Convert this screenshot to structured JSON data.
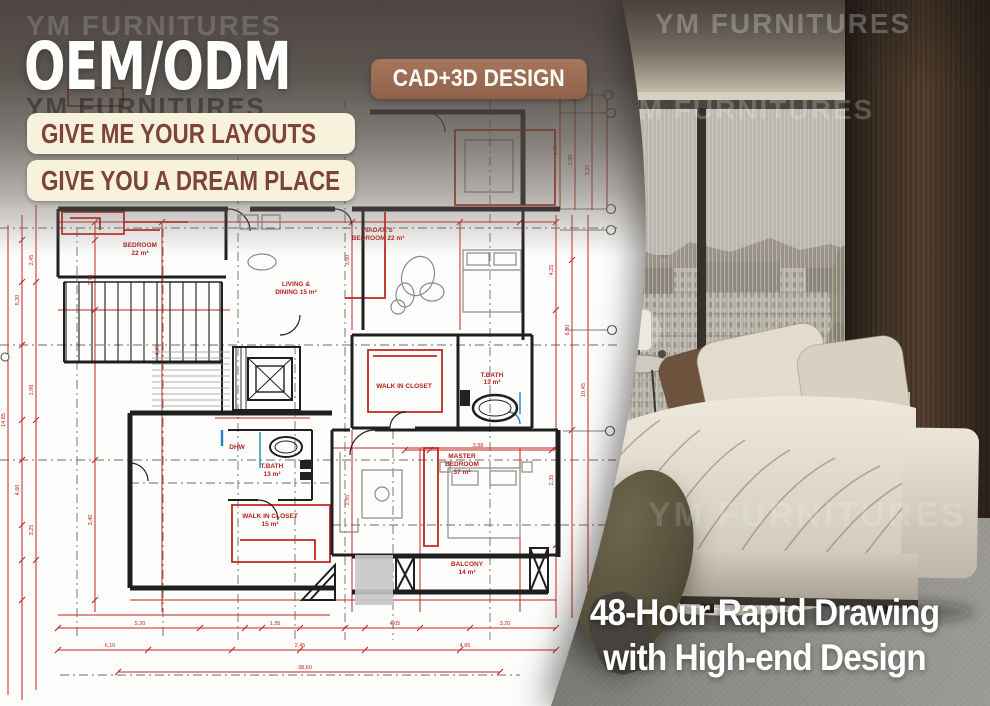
{
  "brand": {
    "watermark": "YM FURNITURES"
  },
  "header": {
    "title": "OEM/ODM",
    "badge": "CAD+3D DESIGN",
    "banner1": "GIVE ME YOUR LAYOUTS",
    "banner2": "GIVE YOU A DREAM PLACE"
  },
  "tagline": {
    "line1": "48-Hour Rapid Drawing",
    "line2": "with High-end Design"
  },
  "colors": {
    "badge_brown": "#9a6a52",
    "banner_cream": "#f8f1dc",
    "banner_text": "#7c443b",
    "plan_red": "#c3251f",
    "plan_blue": "#2383c4",
    "overlay_gray": "#4a423c",
    "tagline_white": "#ffffff"
  },
  "floorplan": {
    "room_labels": [
      {
        "x": 378,
        "y": 232,
        "t": "NADAA'S"
      },
      {
        "x": 378,
        "y": 240,
        "t": "BEDROOM 22 m²"
      },
      {
        "x": 140,
        "y": 247,
        "t": "BEDROOM"
      },
      {
        "x": 140,
        "y": 255,
        "t": "22 m²"
      },
      {
        "x": 296,
        "y": 286,
        "t": "LIVING &"
      },
      {
        "x": 296,
        "y": 294,
        "t": "DINING 15 m²"
      },
      {
        "x": 404,
        "y": 388,
        "t": "WALK IN CLOSET"
      },
      {
        "x": 492,
        "y": 377,
        "t": "T.BATH"
      },
      {
        "x": 492,
        "y": 384,
        "t": "13 m²"
      },
      {
        "x": 272,
        "y": 468,
        "t": "T.BATH"
      },
      {
        "x": 272,
        "y": 476,
        "t": "13 m²"
      },
      {
        "x": 237,
        "y": 449,
        "t": "DHW"
      },
      {
        "x": 270,
        "y": 518,
        "t": "WALK IN CLOSET"
      },
      {
        "x": 270,
        "y": 526,
        "t": "15 m²"
      },
      {
        "x": 462,
        "y": 458,
        "t": "MASTER"
      },
      {
        "x": 462,
        "y": 466,
        "t": "BEDROOM"
      },
      {
        "x": 462,
        "y": 474,
        "t": "37 m²"
      },
      {
        "x": 467,
        "y": 566,
        "t": "BALCONY"
      },
      {
        "x": 467,
        "y": 574,
        "t": "14 m²"
      }
    ],
    "dim_labels": [
      {
        "x": 5,
        "y": 420,
        "r": -90,
        "t": "14,85"
      },
      {
        "x": 19,
        "y": 300,
        "r": -90,
        "t": "5,20"
      },
      {
        "x": 19,
        "y": 490,
        "r": -90,
        "t": "4,60"
      },
      {
        "x": 33,
        "y": 260,
        "r": -90,
        "t": "2,45"
      },
      {
        "x": 33,
        "y": 390,
        "r": -90,
        "t": "1,98"
      },
      {
        "x": 33,
        "y": 530,
        "r": -90,
        "t": "3,25"
      },
      {
        "x": 92,
        "y": 280,
        "r": -90,
        "t": "2,78"
      },
      {
        "x": 92,
        "y": 520,
        "r": -90,
        "t": "3,40"
      },
      {
        "x": 159,
        "y": 350,
        "r": -90,
        "t": "4,25"
      },
      {
        "x": 349,
        "y": 260,
        "r": -90,
        "t": "3,60"
      },
      {
        "x": 349,
        "y": 500,
        "r": -90,
        "t": "2,95"
      },
      {
        "x": 553,
        "y": 270,
        "r": -90,
        "t": "4,25"
      },
      {
        "x": 553,
        "y": 480,
        "r": -90,
        "t": "2,35"
      },
      {
        "x": 569,
        "y": 330,
        "r": -90,
        "t": "6,80"
      },
      {
        "x": 585,
        "y": 390,
        "r": -90,
        "t": "10,45"
      },
      {
        "x": 557,
        "y": 150,
        "r": -90,
        "t": "1,75"
      },
      {
        "x": 572,
        "y": 160,
        "r": -90,
        "t": "2,90"
      },
      {
        "x": 589,
        "y": 170,
        "r": -90,
        "t": "3,25"
      },
      {
        "x": 140,
        "y": 625,
        "t": "5,20"
      },
      {
        "x": 275,
        "y": 625,
        "t": "1,35"
      },
      {
        "x": 395,
        "y": 625,
        "t": "4,05"
      },
      {
        "x": 505,
        "y": 625,
        "t": "3,20"
      },
      {
        "x": 110,
        "y": 647,
        "t": "6,10"
      },
      {
        "x": 300,
        "y": 647,
        "t": "2,45"
      },
      {
        "x": 465,
        "y": 647,
        "t": "4,85"
      },
      {
        "x": 305,
        "y": 669,
        "t": "38,60"
      },
      {
        "x": 478,
        "y": 447,
        "t": "3,98"
      },
      {
        "x": 418,
        "y": 97,
        "t": "1,20"
      }
    ]
  }
}
